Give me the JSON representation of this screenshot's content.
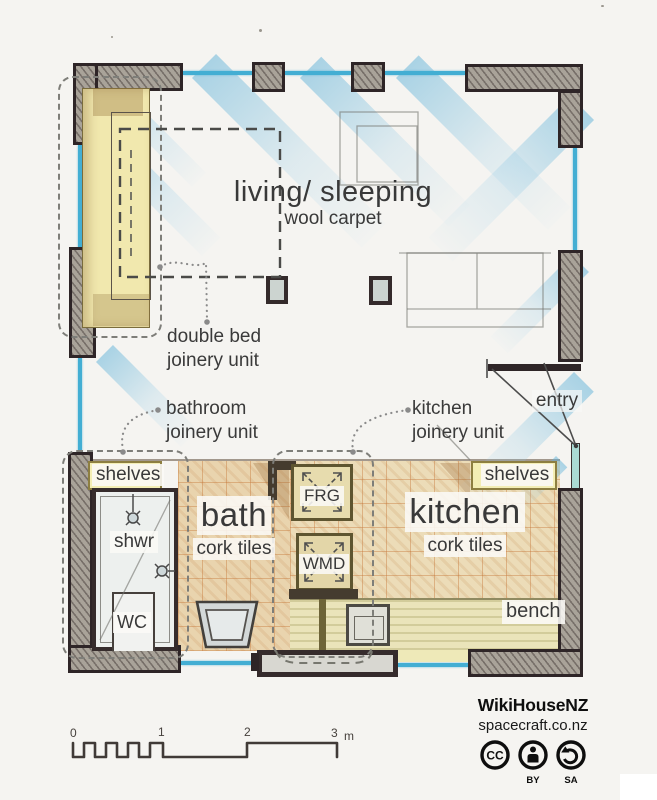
{
  "colors": {
    "paper": "#f5f4f1",
    "wall_dark": "#2e2527",
    "wall_fill": "#a9a399",
    "glazing_blue": "#43aed3",
    "daylight_wash": "#a8d4e8",
    "joinery_yellow": "#f1e8ae",
    "shelf_yellow": "#f3eeb4",
    "cork_tan": "#ecdcb8",
    "cork_grid_orange": "#c67638",
    "bench_yellow": "#eae4ba",
    "teal_frame": "#aadbd4",
    "annotation_gray": "#8a8a8a",
    "ink_text": "#3a3a3a"
  },
  "rooms": {
    "living": {
      "title": "living/ sleeping",
      "subtitle": "wool carpet"
    },
    "bath": {
      "title": "bath",
      "subtitle": "cork tiles"
    },
    "kitchen": {
      "title": "kitchen",
      "subtitle": "cork tiles"
    }
  },
  "annotations": {
    "double_bed": {
      "line1": "double bed",
      "line2": "joinery unit"
    },
    "bathroom": {
      "line1": "bathroom",
      "line2": "joinery unit"
    },
    "kitchen": {
      "line1": "kitchen",
      "line2": "joinery unit"
    }
  },
  "fixtures": {
    "shelves_left": "shelves",
    "shelves_right": "shelves",
    "shower": "shwr",
    "wc": "WC",
    "fridge": "FRG",
    "washer_dryer": "WMD",
    "bench": "bench",
    "entry": "entry"
  },
  "scale_bar": {
    "ticks": [
      "0",
      "1",
      "2",
      "3"
    ],
    "unit": "m"
  },
  "credits": {
    "brand": "WikiHouseNZ",
    "website": "spacecraft.co.nz",
    "license": {
      "cc": "CC",
      "by": "BY",
      "sa": "SA"
    }
  }
}
